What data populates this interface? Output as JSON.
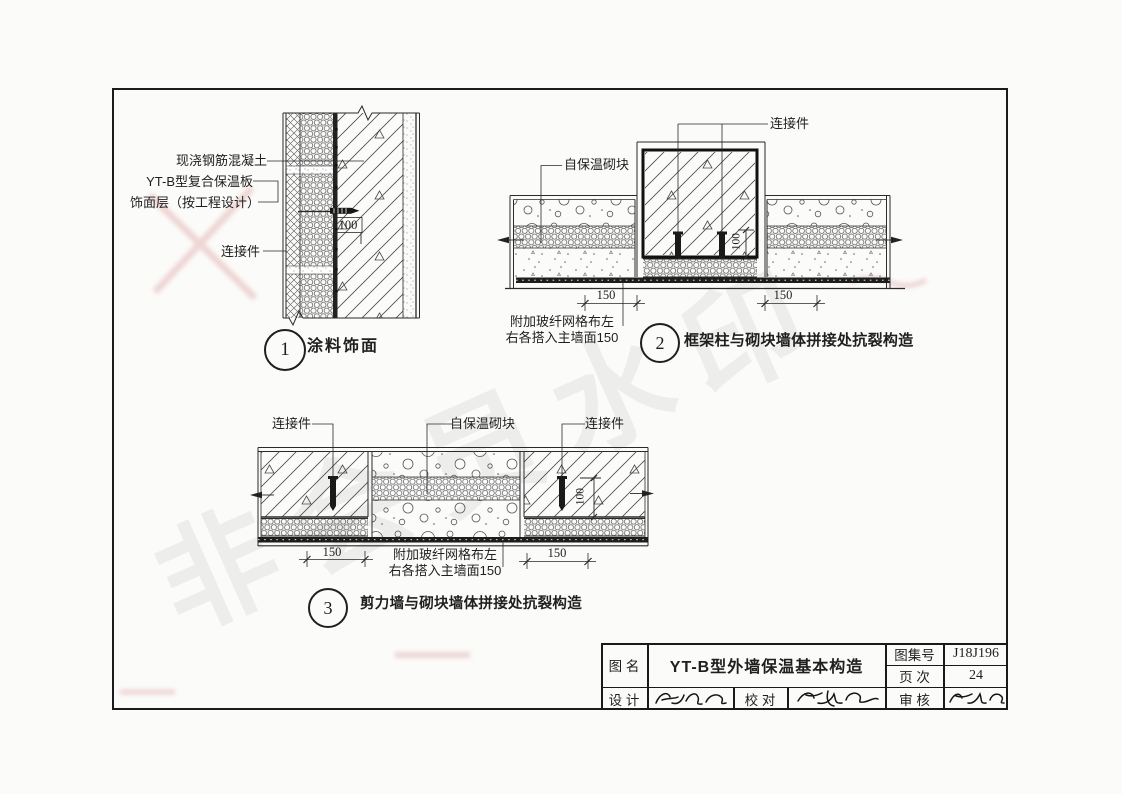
{
  "page": {
    "watermark": "非会员水印",
    "colors": {
      "line": "#1f1f1f",
      "paper": "#fbfbf9",
      "artifact_pink": "#e4b6b6"
    }
  },
  "details": {
    "d1": {
      "number": "1",
      "title": "涂料饰面",
      "labels": {
        "cast_concrete": "现浇钢筋混凝土",
        "composite_panel": "YT-B型复合保温板",
        "finish_layer": "饰面层（按工程设计）",
        "connector": "连接件"
      },
      "dim_embed": "100"
    },
    "d2": {
      "number": "2",
      "title": "框架柱与砌块墙体拼接处抗裂构造",
      "labels": {
        "connector": "连接件",
        "block": "自保温砌块"
      },
      "note_line1": "附加玻纤网格布左",
      "note_line2": "右各搭入主墙面150",
      "dim_left": "150",
      "dim_right": "150",
      "dim_embed": "100"
    },
    "d3": {
      "number": "3",
      "title": "剪力墙与砌块墙体拼接处抗裂构造",
      "labels": {
        "connector_left": "连接件",
        "block": "自保温砌块",
        "connector_right": "连接件"
      },
      "note_line1": "附加玻纤网格布左",
      "note_line2": "右各搭入主墙面150",
      "dim_left": "150",
      "dim_right": "150",
      "dim_embed": "100"
    }
  },
  "title_block": {
    "name_label": "图 名",
    "name_value": "YT-B型外墙保温基本构造",
    "atlas_label": "图集号",
    "atlas_value": "J18J196",
    "page_label": "页 次",
    "page_value": "24",
    "design_label": "设 计",
    "proof_label": "校 对",
    "review_label": "审 核"
  }
}
